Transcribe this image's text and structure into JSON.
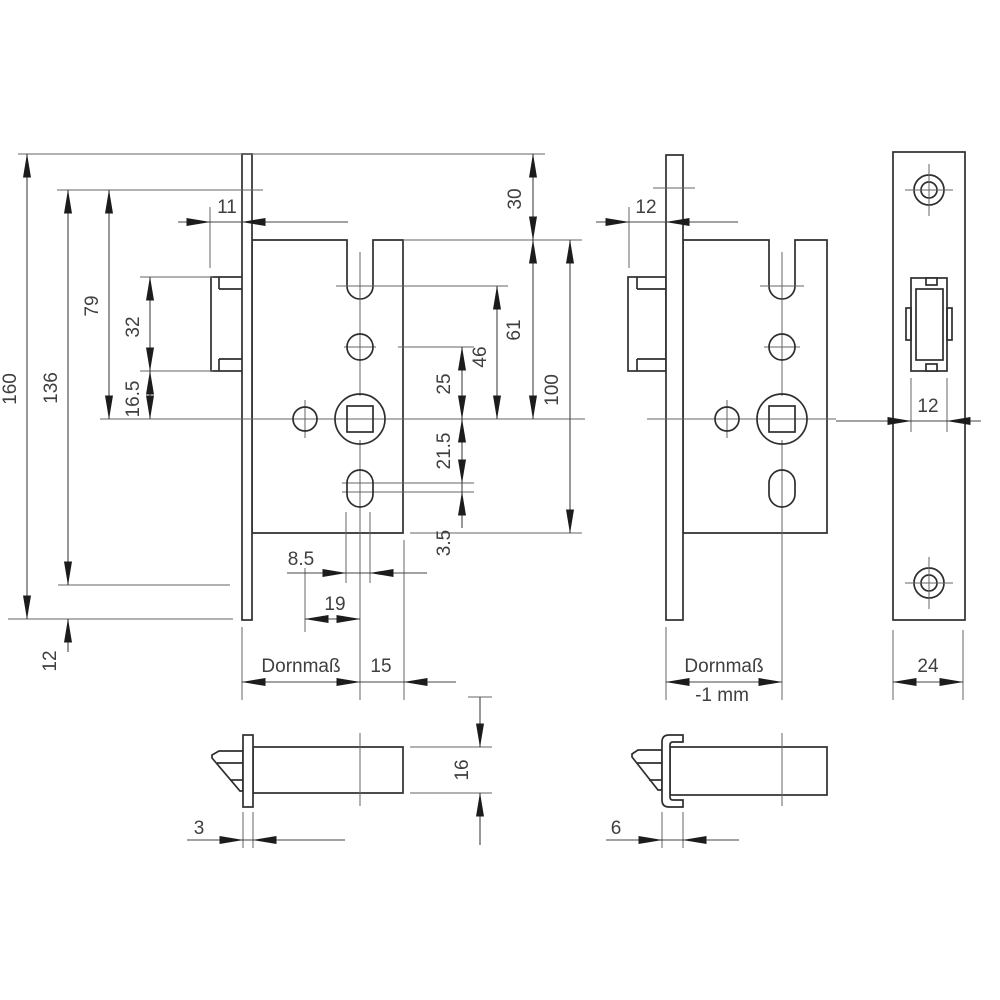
{
  "page": {
    "background": "#ffffff",
    "kind": "technical-drawing",
    "subject": "mortise-lock dimension drawing"
  },
  "colors": {
    "object_line": "#2e2e2e",
    "dim_line": "#444444",
    "text": "#3f3f3f",
    "arrow": "#1c1c1c"
  },
  "views": {
    "lock_front_standard": {
      "dims": {
        "total_height": "160",
        "height_136": "136",
        "top_to_spindle": "79",
        "latch_case_height": "32",
        "latch_to_spindle": "16.5",
        "bottom_offset": "12",
        "latch_protrusion": "11",
        "plate_top_overhang": "30",
        "case_top_to_spindle": "61",
        "latch_axis_to_spindle": "46",
        "cylinder_to_spindle": "25",
        "case_height": "100",
        "spindle_to_slot": "21.5",
        "slot_elongation": "3.5",
        "slot_width": "8.5",
        "aux_to_spindle": "19",
        "backset_label": "Dornmaß",
        "spindle_to_case_back": "15"
      }
    },
    "lock_front_variant": {
      "dims": {
        "latch_protrusion": "12",
        "backset_label": "Dornmaß",
        "backset_note": "-1 mm"
      }
    },
    "faceplate_front": {
      "dims": {
        "latch_width": "12",
        "plate_width": "24"
      }
    },
    "latch_side_flat": {
      "dims": {
        "plate_thickness": "3",
        "latch_height": "16"
      }
    },
    "latch_side_channel": {
      "dims": {
        "plate_thickness": "6"
      }
    }
  }
}
